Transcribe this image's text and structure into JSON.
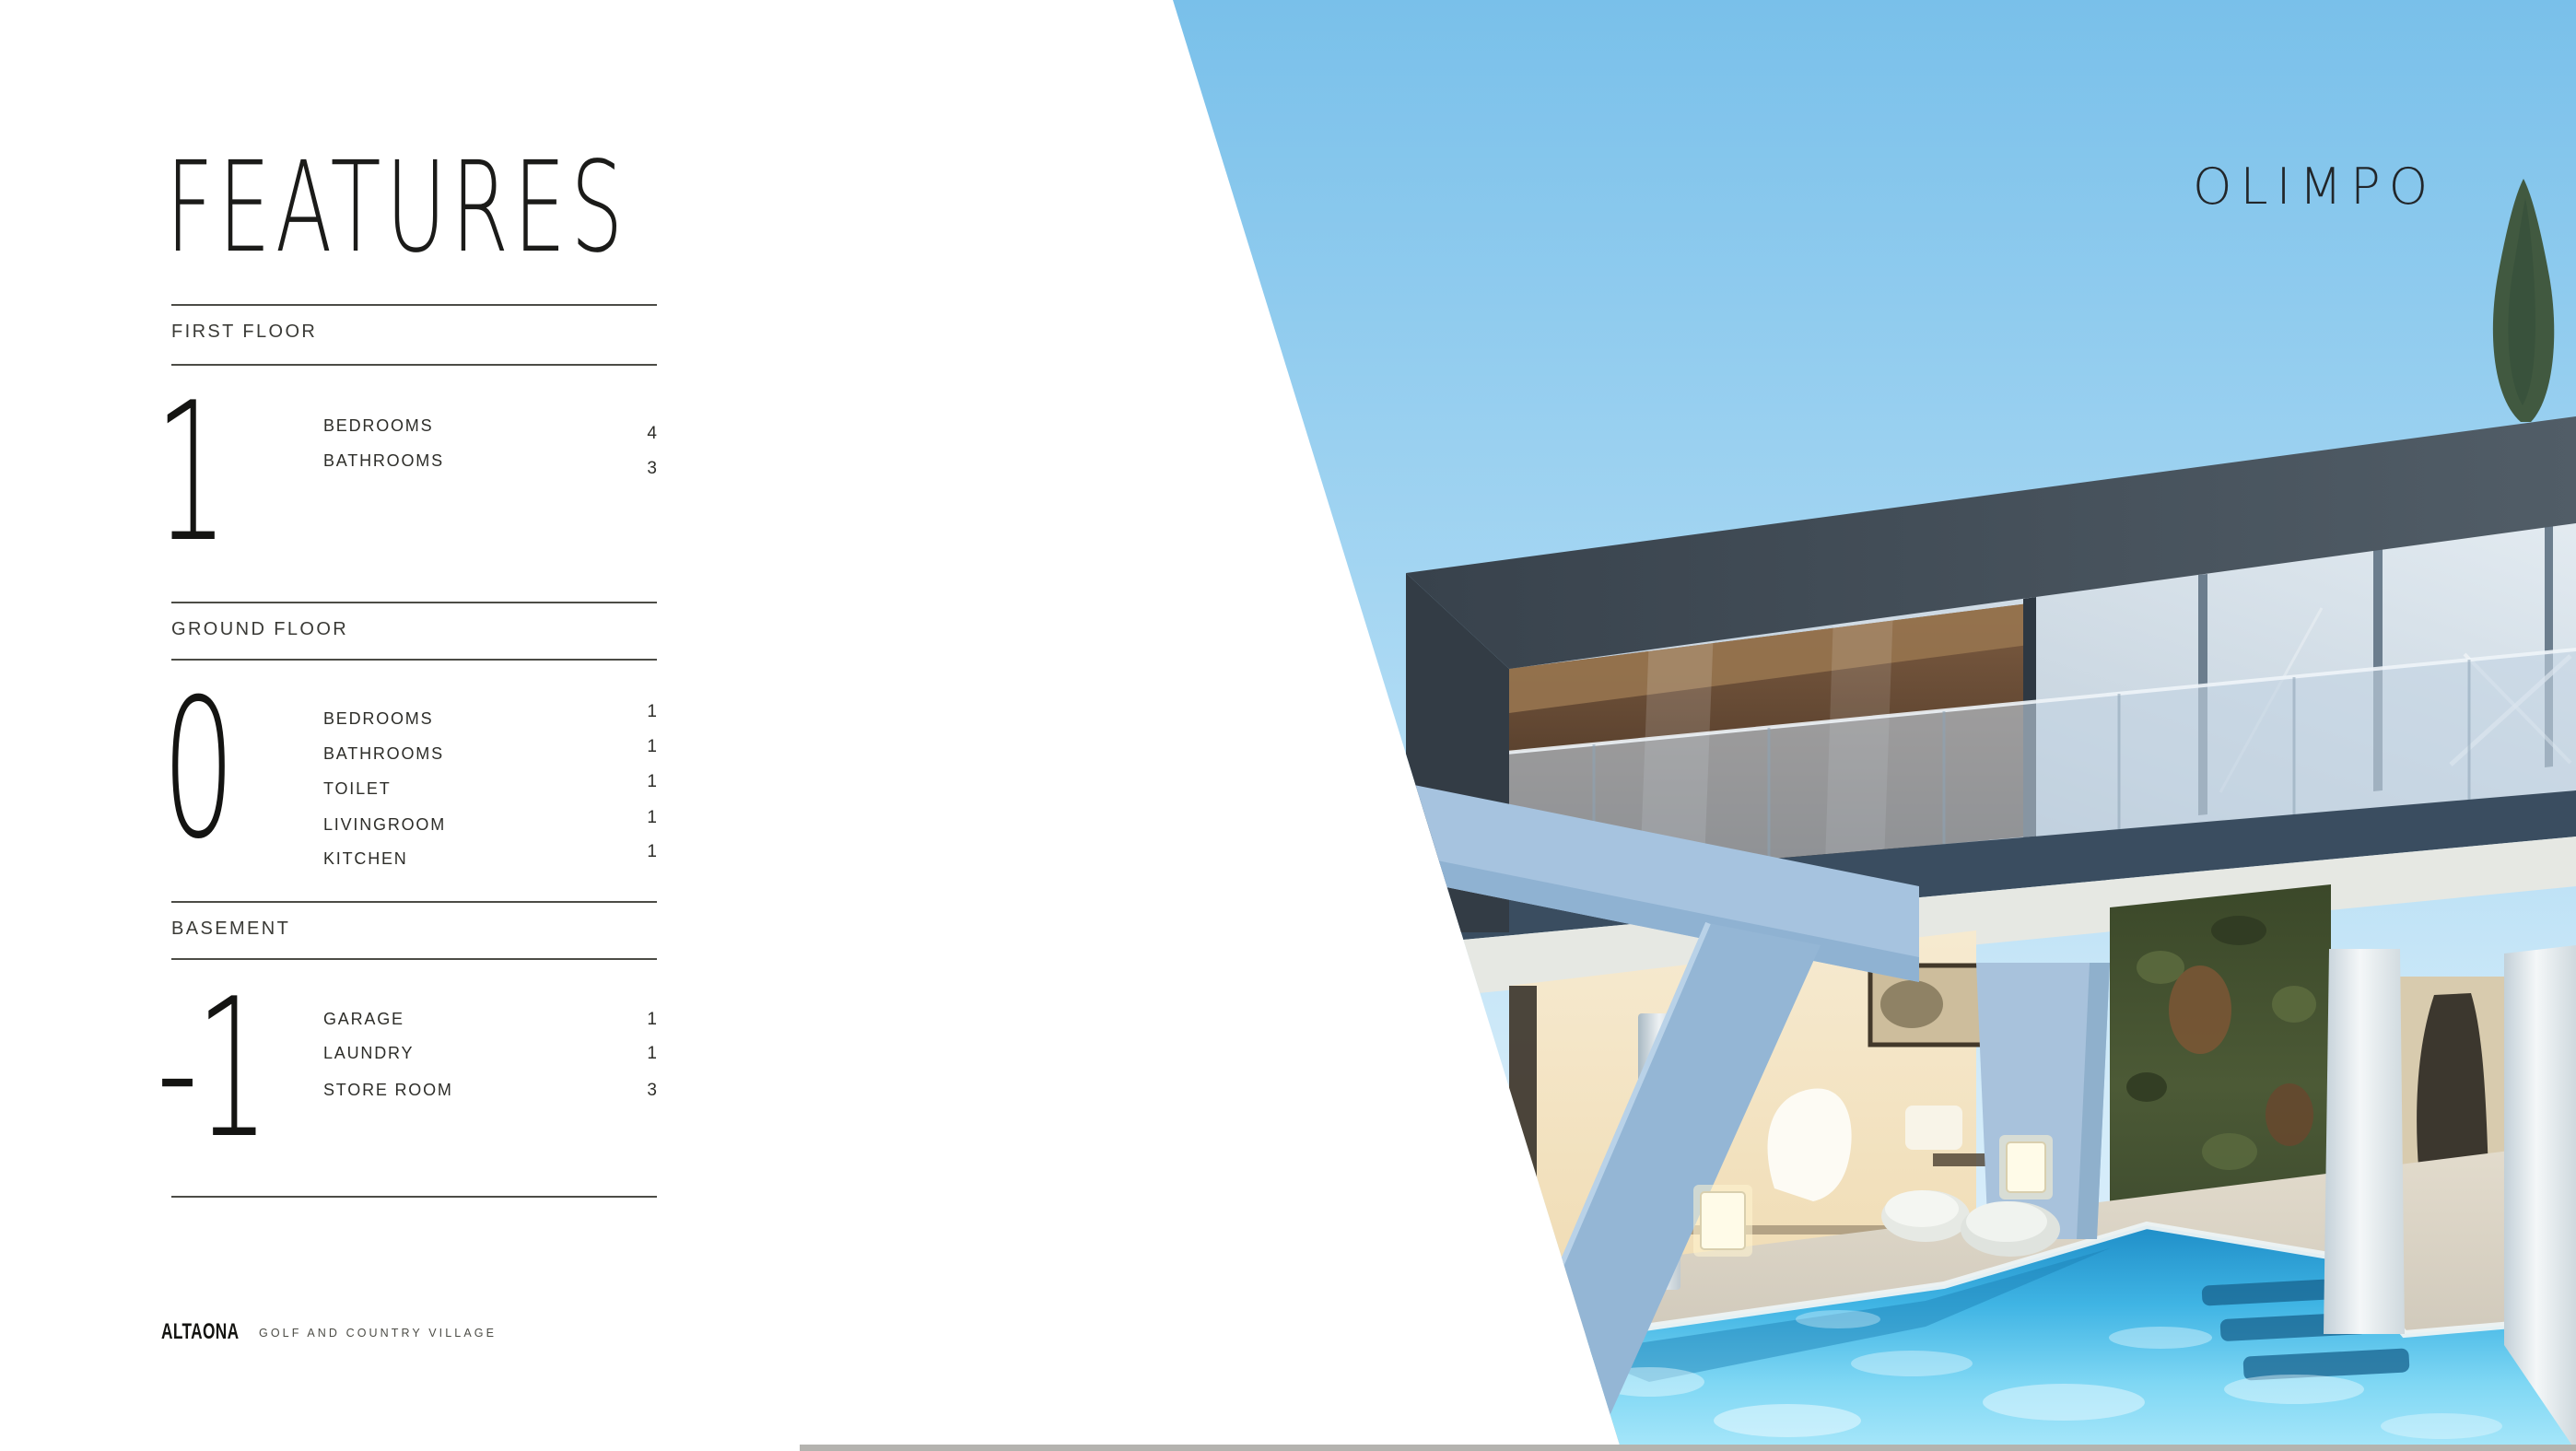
{
  "page_title": "FEATURES",
  "sections": [
    {
      "label": "FIRST FLOOR",
      "level": "1",
      "rooms": [
        {
          "name": "BEDROOMS",
          "count": "4"
        },
        {
          "name": "BATHROOMS",
          "count": "3"
        }
      ]
    },
    {
      "label": "GROUND FLOOR",
      "level": "0",
      "rooms": [
        {
          "name": "BEDROOMS",
          "count": "1"
        },
        {
          "name": "BATHROOMS",
          "count": "1"
        },
        {
          "name": "TOILET",
          "count": "1"
        },
        {
          "name": "LIVINGROOM",
          "count": "1"
        },
        {
          "name": "KITCHEN",
          "count": "1"
        }
      ]
    },
    {
      "label": "BASEMENT",
      "level": "-1",
      "rooms": [
        {
          "name": "GARAGE",
          "count": "1"
        },
        {
          "name": "LAUNDRY",
          "count": "1"
        },
        {
          "name": "STORE ROOM",
          "count": "3"
        }
      ]
    }
  ],
  "photo": {
    "project_label": "OLIMPO"
  },
  "footer": {
    "brand": "ALTAONA",
    "tagline": "GOLF AND COUNTRY VILLAGE"
  },
  "colors": {
    "text": "#1b1b19",
    "rule": "#4c4c46",
    "sky_top": "#7cc2ec",
    "roof": "#3d4751",
    "pool": "#49bae6",
    "accent_structure": "#a6c3df"
  }
}
